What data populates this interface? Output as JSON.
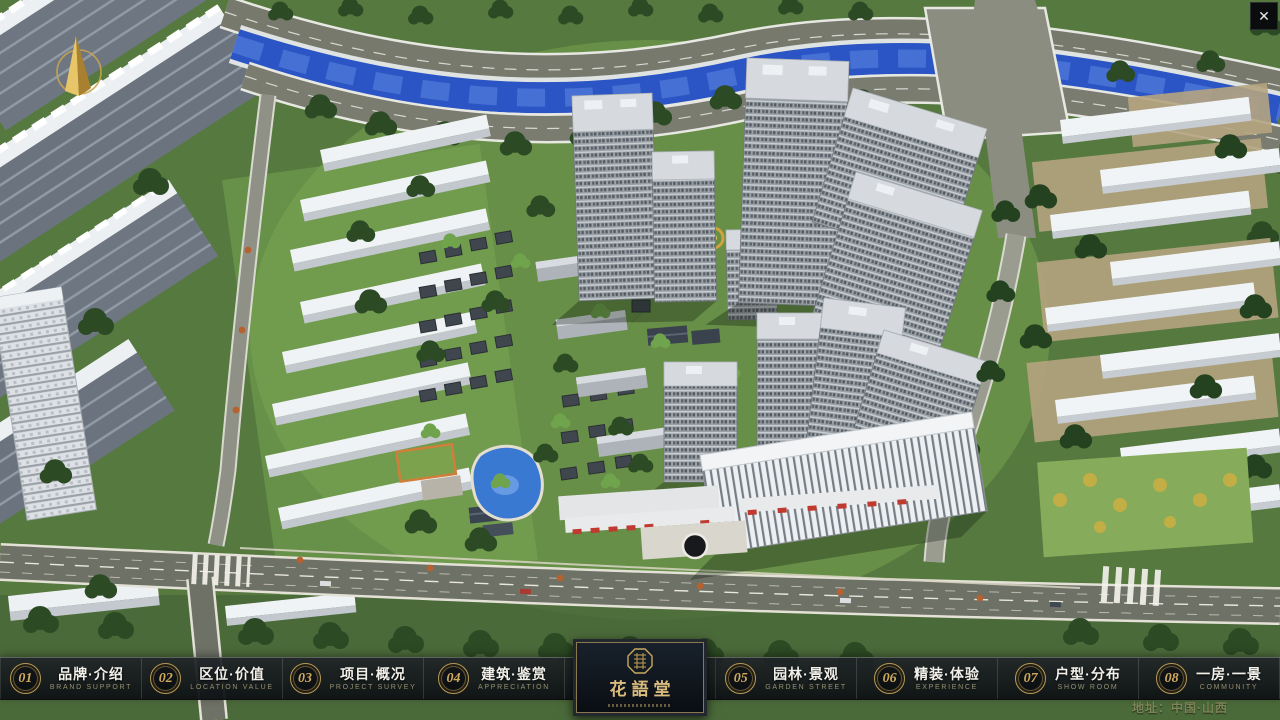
{
  "app": {
    "close_glyph": "✕"
  },
  "nav": {
    "items": [
      {
        "num": "01",
        "label": "品牌·介绍",
        "sub": "BRAND SUPPORT"
      },
      {
        "num": "02",
        "label": "区位·价值",
        "sub": "LOCATION VALUE"
      },
      {
        "num": "03",
        "label": "项目·概况",
        "sub": "PROJECT SURVEY"
      },
      {
        "num": "04",
        "label": "建筑·鉴赏",
        "sub": "APPRECIATION"
      },
      {
        "num": "05",
        "label": "园林·景观",
        "sub": "GARDEN STREET"
      },
      {
        "num": "06",
        "label": "精装·体验",
        "sub": "EXPERIENCE"
      },
      {
        "num": "07",
        "label": "户型·分布",
        "sub": "SHOW ROOM"
      },
      {
        "num": "08",
        "label": "一房·一景",
        "sub": "COMMUNITY"
      }
    ]
  },
  "logo": {
    "name": "花語堂"
  },
  "footer": {
    "address": "地址：中国·山西"
  },
  "colors": {
    "accent_gold": "#c8a45c",
    "bar_bg": "#14181c",
    "river_blue": "#2b55c4",
    "lawn_green": "#74a04c",
    "tree_green": "#2c4a24"
  }
}
